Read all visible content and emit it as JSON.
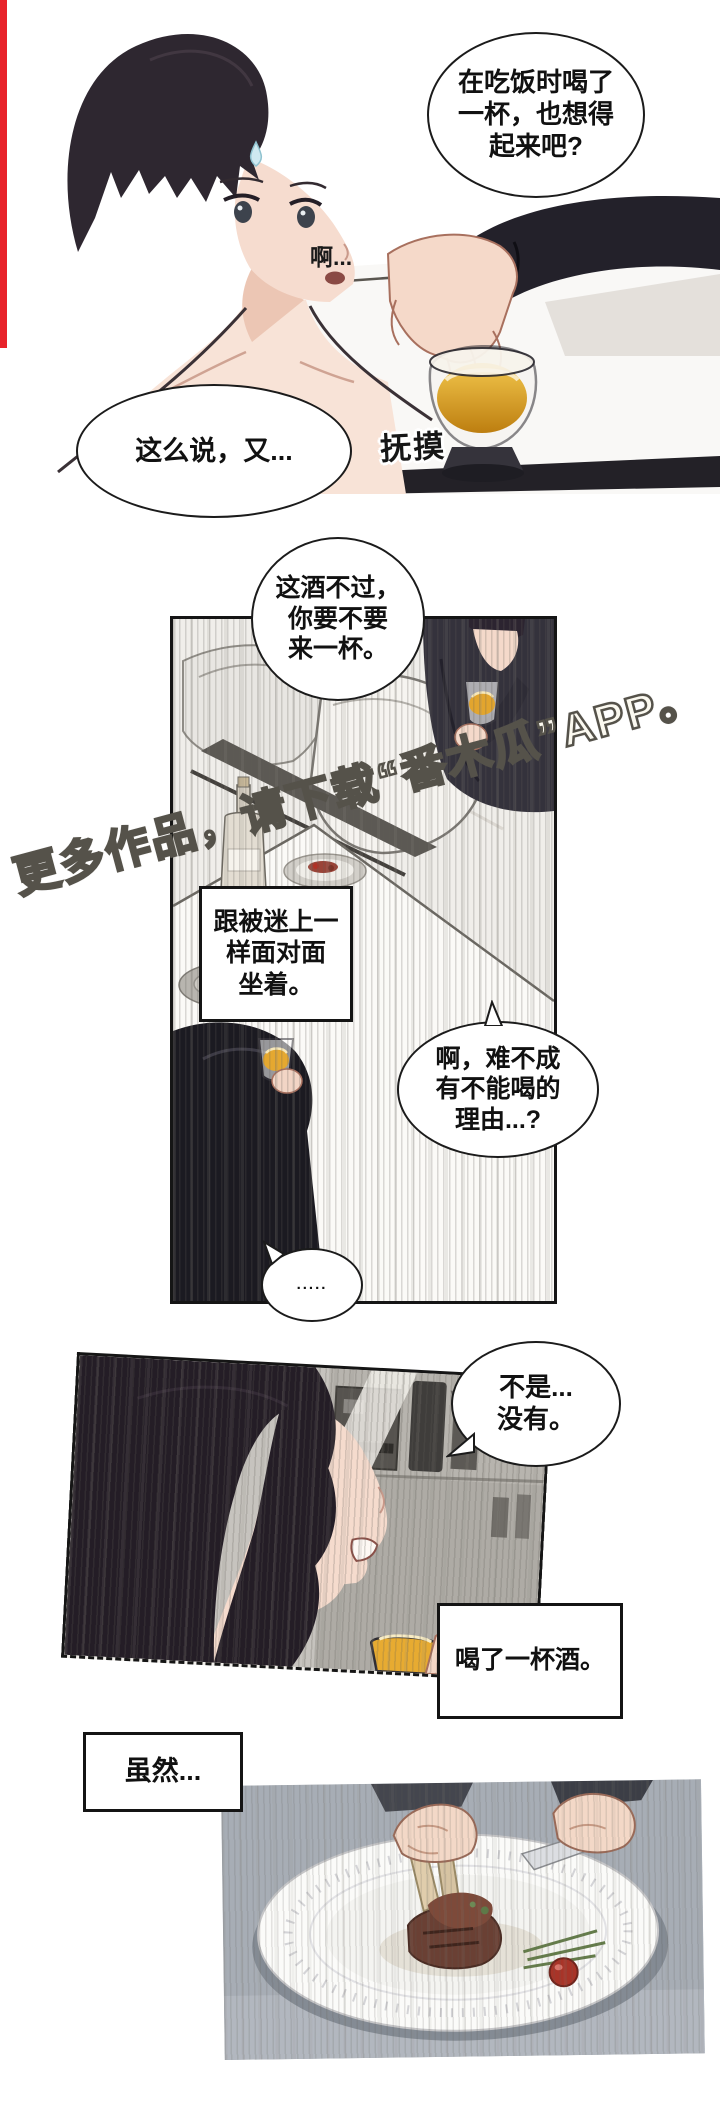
{
  "page": {
    "type_label": "comic-page",
    "colors": {
      "accent_red": "#e8232a",
      "drink_amber": "#e2a52e",
      "panel_border": "#151515",
      "bubble_border": "#1b1b1b"
    }
  },
  "panel1": {
    "bubble_top_right": "在吃饭时喝了\n一杯，也想得\n起来吧?",
    "murmur": "啊...",
    "bubble_bottom_left": "这么说，又...",
    "sfx": "抚摸"
  },
  "panel2": {
    "bubble_offer": "这酒不过，\n你要不要\n来一杯。",
    "caption_box": "跟被迷上一\n样面对面\n坐着。",
    "bubble_question": "啊，难不成\n有不能喝的\n理由...?",
    "bubble_silence": ".....",
    "watermark": "更多作品，请下载“番木瓜”APP。"
  },
  "panel3": {
    "bubble_reply": "不是...\n没有。",
    "caption_box": "喝了一杯酒。"
  },
  "panel4": {
    "caption_box": "虽然..."
  }
}
